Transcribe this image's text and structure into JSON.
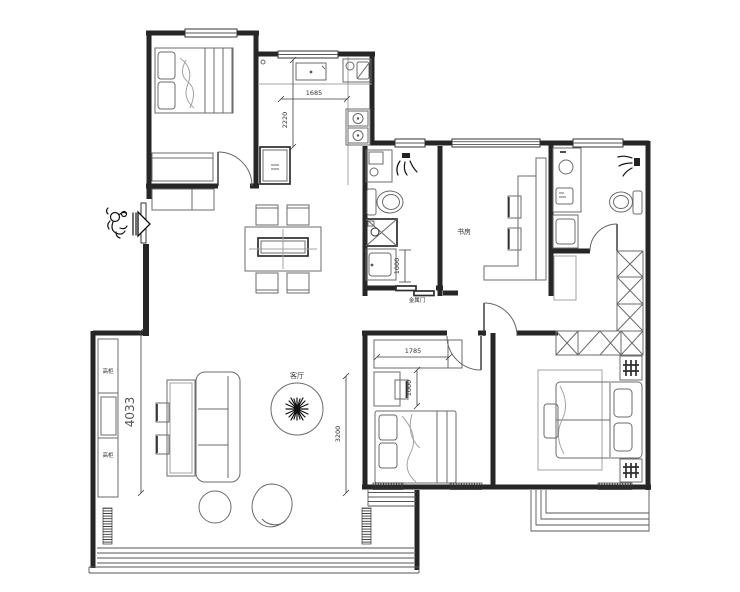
{
  "title": "apartment-floor-plan",
  "labels": {
    "study": "书房",
    "living": "客厅",
    "cabinet_top": "高柜",
    "cabinet_bottom": "高柜",
    "metal_door": "金属门"
  },
  "dimensions": {
    "kitchen_width": "1685",
    "kitchen_depth": "2220",
    "bath_vanity": "1000",
    "living_length": "4033",
    "living_width": "3200",
    "bedroom2_wardrobe": "1785",
    "bedroom2_desk": "1000"
  },
  "icons": {
    "entry_figure": "doodle-person",
    "entry_arrow": "right-arrow",
    "plant": "starburst-plant",
    "shower": "spray-head",
    "stove": "two-burner",
    "washing_machine": "crossed-box",
    "wardrobe": "x-hatch",
    "radiator": "tick-band"
  },
  "colors": {
    "background": "#ffffff",
    "wall": "#262626",
    "furniture": "#6b6b6b",
    "light_furniture": "#a3a3a3",
    "dim": "#3d3d3d",
    "text": "#333333"
  }
}
